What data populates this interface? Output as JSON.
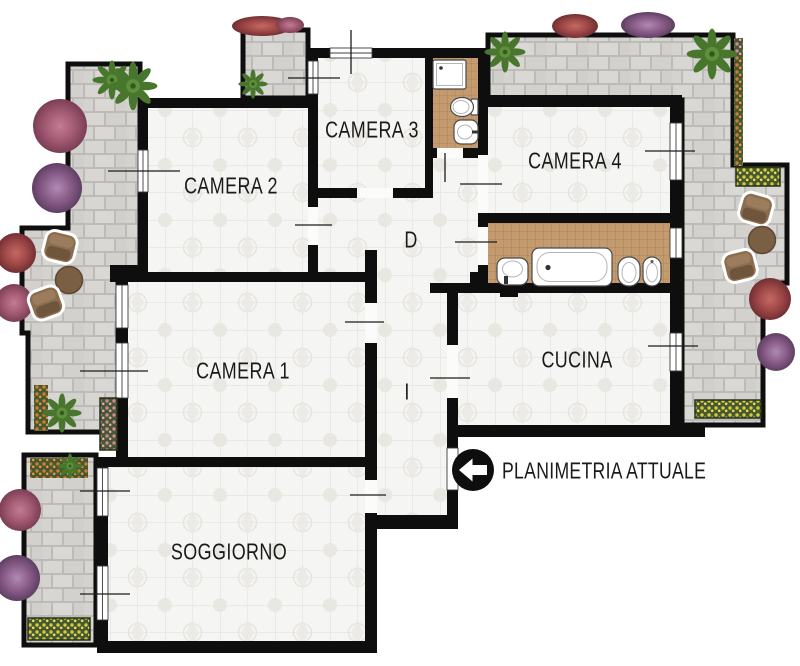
{
  "plan": {
    "type": "floor-plan",
    "legend": {
      "label": "PLANIMETRIA ATTUALE",
      "icon": "arrow-left-icon"
    },
    "rooms": {
      "camera1": {
        "label": "CAMERA 1"
      },
      "camera2": {
        "label": "CAMERA 2"
      },
      "camera3": {
        "label": "CAMERA 3"
      },
      "camera4": {
        "label": "CAMERA 4"
      },
      "cucina": {
        "label": "CUCINA"
      },
      "soggiorno": {
        "label": "SOGGIORNO"
      },
      "disimpegno": {
        "label": "D"
      },
      "ingresso": {
        "label": "I"
      }
    },
    "fixtures": [
      "shower",
      "toilet",
      "sink",
      "bathtub",
      "bidet"
    ],
    "outdoor": [
      "terrace",
      "balcony",
      "plants",
      "bushes",
      "flower-planters",
      "chairs",
      "tables"
    ],
    "colors": {
      "wall": "#0e0e0e",
      "room_floor": "#f5f5f3",
      "terrace_floor": "#d5d4d1",
      "bath_floor": "#c49a6f",
      "text": "#1a1a1a",
      "plant_green": "#5d8f3c",
      "bush_pink": "#a25a72",
      "bush_red": "#a04848",
      "bush_purple": "#8a5d89",
      "flower_orange": "#cf7b35",
      "flower_yellow": "#d9c93c",
      "furniture_brown": "#8b6d4f",
      "fixture_white": "#ffffff"
    }
  }
}
